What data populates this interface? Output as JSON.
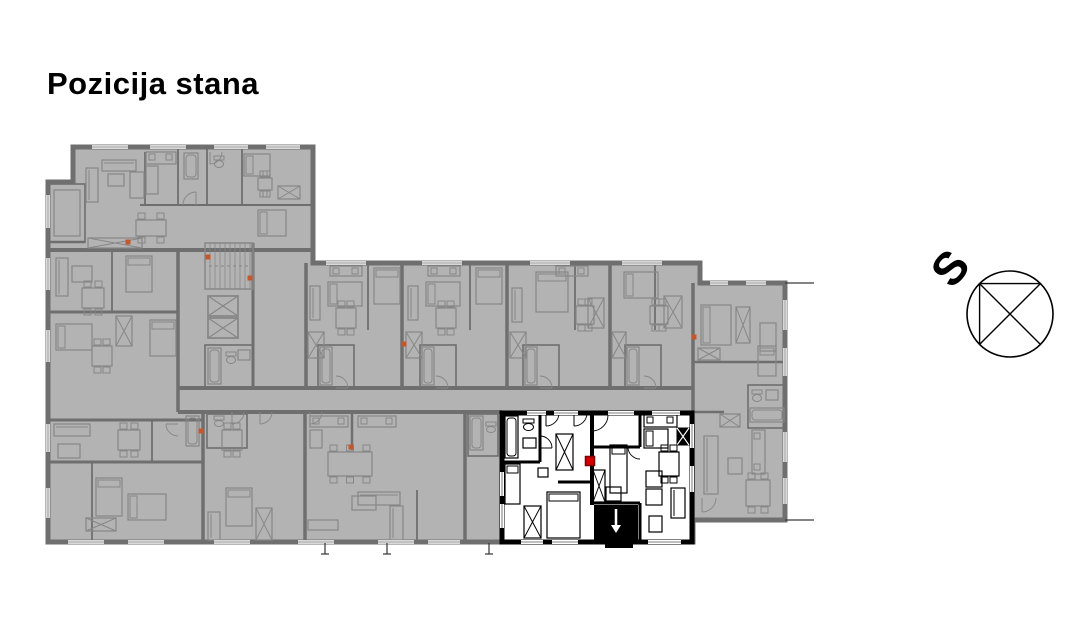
{
  "title": "Pozicija stana",
  "compass": {
    "label": "S"
  },
  "colors": {
    "bg": "#ffffff",
    "plan_fill": "#b3b3b3",
    "wall": "#6f6f6f",
    "furn": "#878787",
    "window_light": "#d9d9d9",
    "window_core": "#9a9a9a",
    "hl_wall": "#000000",
    "hl_fill": "#ffffff",
    "marker_fill": "#d40000",
    "marker_border": "#7d0000",
    "dot": "#c4572d",
    "ink": "#1a1a1a"
  },
  "plan": {
    "outline": [
      [
        73,
        147
      ],
      [
        313,
        147
      ],
      [
        313,
        263
      ],
      [
        700,
        263
      ],
      [
        700,
        283
      ],
      [
        785,
        283
      ],
      [
        785,
        520
      ],
      [
        693,
        520
      ],
      [
        693,
        542
      ],
      [
        48,
        542
      ],
      [
        48,
        182
      ],
      [
        73,
        182
      ]
    ],
    "terrace_lines": [
      [
        785,
        283,
        814,
        283
      ],
      [
        785,
        520,
        814,
        520
      ]
    ],
    "walls": [
      [
        48,
        250,
        313,
        250,
        4
      ],
      [
        140,
        205,
        313,
        205,
        2
      ],
      [
        145,
        152,
        145,
        205,
        1.8
      ],
      [
        178,
        147,
        178,
        205,
        1.8
      ],
      [
        207,
        147,
        207,
        205,
        1.8
      ],
      [
        242,
        147,
        242,
        205,
        1.8
      ],
      [
        48,
        242,
        85,
        242,
        2.5
      ],
      [
        178,
        250,
        178,
        412,
        3.5
      ],
      [
        253,
        243,
        253,
        388,
        3
      ],
      [
        48,
        312,
        178,
        312,
        3
      ],
      [
        112,
        250,
        112,
        312,
        1.8
      ],
      [
        178,
        388,
        693,
        388,
        4
      ],
      [
        178,
        412,
        502,
        412,
        4
      ],
      [
        48,
        420,
        203,
        420,
        3
      ],
      [
        152,
        420,
        152,
        462,
        1.8
      ],
      [
        48,
        462,
        203,
        462,
        3
      ],
      [
        92,
        462,
        92,
        542,
        1.8
      ],
      [
        306,
        263,
        306,
        388,
        3.5
      ],
      [
        402,
        263,
        402,
        388,
        3.5
      ],
      [
        507,
        263,
        507,
        388,
        3.5
      ],
      [
        610,
        263,
        610,
        388,
        3.5
      ],
      [
        693,
        283,
        693,
        542,
        3.5
      ],
      [
        693,
        362,
        785,
        362,
        2.5
      ],
      [
        693,
        412,
        724,
        412,
        2.5
      ],
      [
        203,
        412,
        203,
        542,
        3.5
      ],
      [
        305,
        412,
        305,
        542,
        3.5
      ],
      [
        352,
        413,
        352,
        450,
        2.5
      ],
      [
        465,
        412,
        465,
        542,
        3.5
      ],
      [
        417,
        490,
        417,
        542,
        1.8
      ],
      [
        368,
        263,
        368,
        330,
        1.8
      ],
      [
        470,
        263,
        470,
        330,
        1.8
      ],
      [
        575,
        263,
        575,
        330,
        1.8
      ],
      [
        655,
        263,
        655,
        330,
        1.8
      ]
    ],
    "rooms": [
      [
        318,
        345,
        36,
        43
      ],
      [
        420,
        345,
        36,
        43
      ],
      [
        523,
        345,
        36,
        43
      ],
      [
        625,
        345,
        36,
        43
      ],
      [
        205,
        345,
        48,
        43
      ],
      [
        207,
        414,
        40,
        34
      ],
      [
        468,
        414,
        30,
        42
      ],
      [
        748,
        385,
        37,
        43
      ],
      [
        49,
        184,
        36,
        58
      ]
    ],
    "furn": [
      [
        "k",
        146,
        152,
        30,
        12
      ],
      [
        "r",
        146,
        166,
        12,
        28
      ],
      [
        "tub",
        184,
        153,
        14,
        26
      ],
      [
        "wc",
        214,
        156,
        10,
        12
      ],
      [
        "arc",
        210,
        152,
        12,
        0
      ],
      [
        "s",
        86,
        168,
        12,
        34
      ],
      [
        "s",
        102,
        160,
        34,
        11
      ],
      [
        "r",
        108,
        174,
        16,
        12
      ],
      [
        "r",
        130,
        172,
        14,
        26
      ],
      [
        "bh",
        244,
        154,
        26,
        22
      ],
      [
        "t",
        258,
        178,
        14,
        12
      ],
      [
        "x",
        278,
        186,
        22,
        13
      ],
      [
        "bh",
        258,
        210,
        28,
        26
      ],
      [
        "t",
        136,
        220,
        30,
        16
      ],
      [
        "x",
        88,
        238,
        54,
        10
      ],
      [
        "arc",
        196,
        205,
        13,
        2
      ],
      [
        "r",
        54,
        190,
        26,
        46
      ],
      [
        "s",
        56,
        258,
        12,
        38
      ],
      [
        "r",
        72,
        266,
        20,
        16
      ],
      [
        "b",
        126,
        256,
        26,
        36
      ],
      [
        "t",
        82,
        288,
        22,
        20
      ],
      [
        "bh",
        56,
        324,
        36,
        26
      ],
      [
        "b",
        150,
        320,
        26,
        36
      ],
      [
        "x",
        116,
        316,
        16,
        30
      ],
      [
        "t",
        92,
        346,
        20,
        20
      ],
      [
        "st",
        205,
        243,
        48,
        46
      ],
      [
        "elev",
        208,
        296,
        30,
        20
      ],
      [
        "elev",
        208,
        318,
        30,
        20
      ],
      [
        "tub",
        208,
        348,
        13,
        36
      ],
      [
        "wc",
        226,
        352,
        10,
        12
      ],
      [
        "r",
        238,
        350,
        12,
        10
      ],
      [
        "k",
        330,
        266,
        32,
        10
      ],
      [
        "bh",
        328,
        282,
        34,
        24
      ],
      [
        "b",
        374,
        268,
        26,
        36
      ],
      [
        "t",
        336,
        308,
        20,
        20
      ],
      [
        "s",
        310,
        286,
        10,
        34
      ],
      [
        "x",
        308,
        332,
        16,
        26
      ],
      [
        "tub",
        320,
        347,
        12,
        38
      ],
      [
        "arc",
        336,
        388,
        12,
        3
      ],
      [
        "k",
        428,
        266,
        32,
        10
      ],
      [
        "bh",
        426,
        282,
        34,
        24
      ],
      [
        "b",
        476,
        268,
        26,
        36
      ],
      [
        "t",
        436,
        308,
        20,
        20
      ],
      [
        "s",
        408,
        286,
        10,
        34
      ],
      [
        "x",
        406,
        332,
        16,
        26
      ],
      [
        "tub",
        422,
        347,
        12,
        38
      ],
      [
        "arc",
        436,
        388,
        12,
        3
      ],
      [
        "k",
        556,
        266,
        32,
        10
      ],
      [
        "b",
        536,
        272,
        32,
        40
      ],
      [
        "t",
        576,
        306,
        18,
        18
      ],
      [
        "s",
        512,
        288,
        10,
        34
      ],
      [
        "x",
        510,
        332,
        16,
        26
      ],
      [
        "tub",
        525,
        347,
        12,
        38
      ],
      [
        "x",
        588,
        298,
        16,
        30
      ],
      [
        "arc",
        540,
        388,
        12,
        3
      ],
      [
        "bh",
        624,
        272,
        34,
        26
      ],
      [
        "t",
        650,
        306,
        18,
        18
      ],
      [
        "x",
        612,
        332,
        14,
        26
      ],
      [
        "tub",
        627,
        347,
        12,
        38
      ],
      [
        "x",
        664,
        296,
        18,
        32
      ],
      [
        "arc",
        644,
        388,
        12,
        3
      ],
      [
        "bh",
        701,
        305,
        30,
        40
      ],
      [
        "x",
        736,
        307,
        14,
        36
      ],
      [
        "r",
        760,
        323,
        16,
        28
      ],
      [
        "x",
        698,
        348,
        22,
        12
      ],
      [
        "b",
        758,
        346,
        18,
        30
      ],
      [
        "wc",
        752,
        390,
        10,
        12
      ],
      [
        "r",
        766,
        390,
        12,
        10
      ],
      [
        "tub",
        750,
        408,
        34,
        14
      ],
      [
        "x",
        720,
        414,
        20,
        13
      ],
      [
        "k",
        752,
        430,
        13,
        44
      ],
      [
        "s",
        704,
        436,
        14,
        58
      ],
      [
        "r",
        728,
        458,
        14,
        16
      ],
      [
        "t",
        746,
        480,
        24,
        26
      ],
      [
        "arc",
        702,
        498,
        14,
        0
      ],
      [
        "s",
        54,
        424,
        36,
        12
      ],
      [
        "r",
        58,
        444,
        22,
        14
      ],
      [
        "t",
        118,
        430,
        22,
        20
      ],
      [
        "tub",
        186,
        416,
        13,
        30
      ],
      [
        "b",
        96,
        478,
        26,
        38
      ],
      [
        "bh",
        128,
        494,
        38,
        26
      ],
      [
        "x",
        86,
        518,
        30,
        13
      ],
      [
        "arc",
        178,
        424,
        12,
        1
      ],
      [
        "t",
        222,
        430,
        20,
        20
      ],
      [
        "b",
        226,
        488,
        26,
        38
      ],
      [
        "x",
        256,
        508,
        16,
        32
      ],
      [
        "s",
        208,
        512,
        12,
        28
      ],
      [
        "wc",
        214,
        416,
        10,
        11
      ],
      [
        "arc",
        232,
        412,
        12,
        0
      ],
      [
        "k",
        310,
        416,
        38,
        11
      ],
      [
        "k",
        358,
        416,
        38,
        11
      ],
      [
        "r",
        310,
        430,
        12,
        18
      ],
      [
        "t",
        328,
        452,
        44,
        24
      ],
      [
        "s",
        358,
        492,
        42,
        13
      ],
      [
        "s",
        390,
        506,
        13,
        34
      ],
      [
        "r",
        352,
        496,
        24,
        14
      ],
      [
        "r",
        308,
        520,
        30,
        10
      ],
      [
        "arc",
        310,
        412,
        12,
        0
      ],
      [
        "arc",
        260,
        412,
        12,
        0
      ],
      [
        "tub",
        470,
        416,
        13,
        34
      ],
      [
        "wc",
        486,
        422,
        10,
        11
      ]
    ],
    "windows": [
      [
        92,
        147,
        128,
        147
      ],
      [
        150,
        147,
        186,
        147
      ],
      [
        214,
        147,
        248,
        147
      ],
      [
        266,
        147,
        300,
        147
      ],
      [
        326,
        263,
        366,
        263
      ],
      [
        422,
        263,
        462,
        263
      ],
      [
        530,
        263,
        570,
        263
      ],
      [
        622,
        263,
        662,
        263
      ],
      [
        710,
        283,
        728,
        283
      ],
      [
        746,
        283,
        766,
        283
      ],
      [
        48,
        195,
        48,
        228
      ],
      [
        48,
        258,
        48,
        290
      ],
      [
        48,
        330,
        48,
        362
      ],
      [
        48,
        424,
        48,
        452
      ],
      [
        48,
        488,
        48,
        518
      ],
      [
        68,
        542,
        104,
        542
      ],
      [
        128,
        542,
        164,
        542
      ],
      [
        214,
        542,
        250,
        542
      ],
      [
        298,
        542,
        334,
        542
      ],
      [
        378,
        542,
        414,
        542
      ],
      [
        428,
        542,
        460,
        542
      ],
      [
        785,
        300,
        785,
        330
      ],
      [
        785,
        348,
        785,
        376
      ],
      [
        785,
        432,
        785,
        462
      ],
      [
        785,
        478,
        785,
        504
      ]
    ],
    "dots": [
      [
        208,
        257
      ],
      [
        250,
        278
      ],
      [
        128,
        242
      ],
      [
        404,
        344
      ],
      [
        201,
        431
      ],
      [
        694,
        337
      ],
      [
        351,
        447
      ]
    ],
    "ticks": [
      325,
      387,
      489
    ],
    "highlight": {
      "rect": [
        502,
        413,
        190,
        129
      ],
      "walls": [
        [
          592,
          413,
          592,
          505,
          4
        ],
        [
          540,
          413,
          540,
          462,
          3
        ],
        [
          502,
          462,
          540,
          462,
          3
        ],
        [
          558,
          482,
          592,
          482,
          3
        ],
        [
          640,
          413,
          640,
          447,
          3
        ],
        [
          592,
          447,
          640,
          447,
          3
        ],
        [
          592,
          503,
          640,
          503,
          3
        ],
        [
          640,
          503,
          640,
          542,
          3
        ]
      ],
      "black_rects": [
        [
          594,
          505,
          44,
          35
        ],
        [
          605,
          542,
          28,
          6
        ]
      ],
      "furn": [
        [
          "tub",
          505,
          416,
          13,
          42
        ],
        [
          "wc",
          523,
          419,
          11,
          12
        ],
        [
          "r",
          523,
          438,
          13,
          10
        ],
        [
          "arc",
          540,
          448,
          12,
          3
        ],
        [
          "arc",
          546,
          413,
          13,
          0
        ],
        [
          "arc",
          574,
          413,
          13,
          0
        ],
        [
          "b",
          505,
          464,
          15,
          40
        ],
        [
          "x",
          524,
          506,
          17,
          32
        ],
        [
          "b",
          547,
          492,
          33,
          46
        ],
        [
          "x",
          556,
          434,
          17,
          36
        ],
        [
          "r",
          538,
          468,
          10,
          9
        ],
        [
          "arc",
          592,
          415,
          16,
          0
        ],
        [
          "b",
          610,
          445,
          17,
          48
        ],
        [
          "x",
          593,
          470,
          12,
          32
        ],
        [
          "r",
          606,
          487,
          15,
          14
        ],
        [
          "k",
          644,
          415,
          33,
          12
        ],
        [
          "bx",
          677,
          428,
          12,
          17
        ],
        [
          "bh",
          644,
          429,
          24,
          19
        ],
        [
          "t",
          659,
          452,
          20,
          24
        ],
        [
          "r",
          646,
          471,
          16,
          16
        ],
        [
          "r",
          646,
          489,
          16,
          16
        ],
        [
          "s",
          671,
          488,
          14,
          30
        ],
        [
          "r",
          649,
          516,
          13,
          16
        ],
        [
          "arc",
          640,
          447,
          12,
          1
        ]
      ],
      "windows": [
        [
          527,
          413,
          546,
          413
        ],
        [
          554,
          413,
          578,
          413
        ],
        [
          608,
          413,
          634,
          413
        ],
        [
          652,
          413,
          680,
          413
        ],
        [
          521,
          542,
          543,
          542
        ],
        [
          552,
          542,
          578,
          542
        ],
        [
          648,
          542,
          681,
          542
        ],
        [
          692,
          424,
          692,
          448
        ],
        [
          692,
          466,
          692,
          492
        ],
        [
          502,
          472,
          502,
          496
        ],
        [
          502,
          504,
          502,
          528
        ]
      ],
      "arrow": [
        616,
        509,
        616,
        526
      ],
      "marker": [
        585.5,
        456.5,
        9,
        9
      ]
    },
    "compass": {
      "cx": 1010,
      "cy": 314,
      "r": 43,
      "lines": [
        [
          979.6,
          283.6,
          1040.4,
          344.4
        ],
        [
          1040.4,
          283.6,
          979.6,
          344.4
        ],
        [
          979.6,
          283.6,
          1040.4,
          283.6
        ],
        [
          979.6,
          283.6,
          979.6,
          344.4
        ]
      ],
      "label_x": 950,
      "label_y": 268,
      "label_rotate": -50
    }
  }
}
